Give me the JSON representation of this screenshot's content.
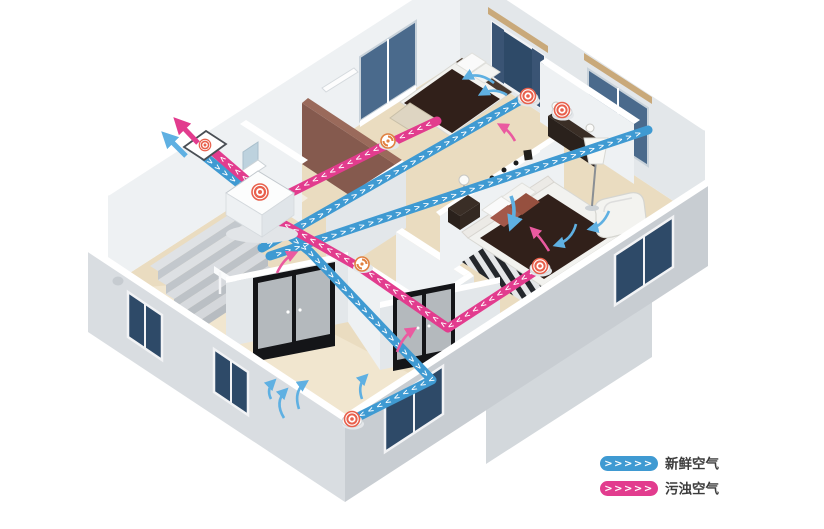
{
  "legend": {
    "items": [
      {
        "id": "fresh-air",
        "label": "新鲜空气",
        "chevrons": ">>>>>",
        "color": "#3f9ad2"
      },
      {
        "id": "exhaust-air",
        "label": "污浊空气",
        "chevrons": ">>>>>",
        "color": "#e23c8e"
      }
    ]
  },
  "ducts": {
    "chevron_string": ">>>>>>>>>>>>>>>>>>>>>>>>>>>>>>>>>>>>>>>>>>>>>>>>>>>>>>>>>>>>"
  },
  "icons": {
    "supply_diffuser": "target-rings-icon",
    "exhaust_grille": "swirl-icon",
    "ventilation_unit": "target-badge-icon",
    "wall_vent": "target-badge-icon",
    "flow_arrow": "curved-arrow-icon"
  },
  "colors": {
    "fresh": "#3f9ad2",
    "exhaust": "#e23c8e",
    "arrow_blue": "#5fb0e2",
    "arrow_pink": "#ea5aa0",
    "accent_coral": "#e8604c",
    "grille_orange": "#e08040",
    "wall_face": "#eef1f3",
    "wall_face_md": "#e3e7ea",
    "wall_face_dk": "#d3d8dc",
    "wall_ext": "#d9dde1",
    "wall_ext_dk": "#c8cdd2",
    "floor": "#eadcc0",
    "floor_lt": "#f1e6cf",
    "glass": "#4a6a8c",
    "glass_dk": "#2e4a68",
    "lintel": "#c9a97a",
    "brown_wall": "#9a6a5b",
    "brown_wall_dk": "#855a4e",
    "duvet": "#31201a",
    "pillow": "#a3584a",
    "dark_furn": "#2a211c",
    "door_frame": "#141518",
    "door_panel": "#b4b9bd",
    "legend_text": "#3c3c3c"
  }
}
